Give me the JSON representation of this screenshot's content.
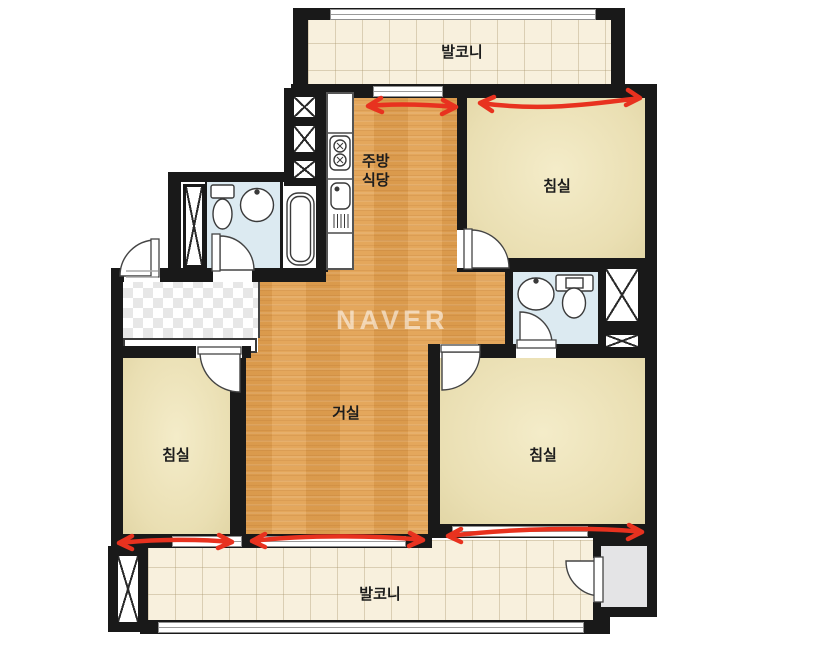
{
  "watermark": {
    "text": "NAVER"
  },
  "rooms": {
    "balcony_top": {
      "label": "발코니"
    },
    "kitchen_dining": {
      "label_line1": "주방",
      "label_line2": "식당"
    },
    "bedroom_top_right": {
      "label": "침실"
    },
    "living_room": {
      "label": "거실"
    },
    "bedroom_bottom_left": {
      "label": "침실"
    },
    "bedroom_bottom_right": {
      "label": "침실"
    },
    "balcony_bottom": {
      "label": "발코니"
    }
  },
  "colors": {
    "wall": "#191919",
    "wood_floor": "#E2A050",
    "bedroom_floor": "#EADFB3",
    "balcony_tile": "#F8F0DD",
    "bathroom_floor": "#DCEAF1",
    "storage_floor": "#E4E4E6",
    "annotation_red": "#E8321F"
  },
  "annotations": {
    "shape": "double-headed-arrow",
    "color": "#E8321F",
    "count": 5,
    "locations": [
      "kitchen-top-wall",
      "bedroom-top-right-top-wall",
      "bedroom-bottom-left-bottom-wall",
      "living-room-bottom-wall",
      "bedroom-bottom-right-bottom-wall"
    ]
  },
  "fixtures": [
    "stove-icon",
    "kitchen-sink-icon",
    "bathtub-icon",
    "toilet-icon-left-bath",
    "washbasin-icon-left-bath",
    "toilet-icon-right-bath",
    "washbasin-icon-right-bath",
    "duct-shaft-x",
    "door-swing-arc",
    "window-glyph"
  ]
}
